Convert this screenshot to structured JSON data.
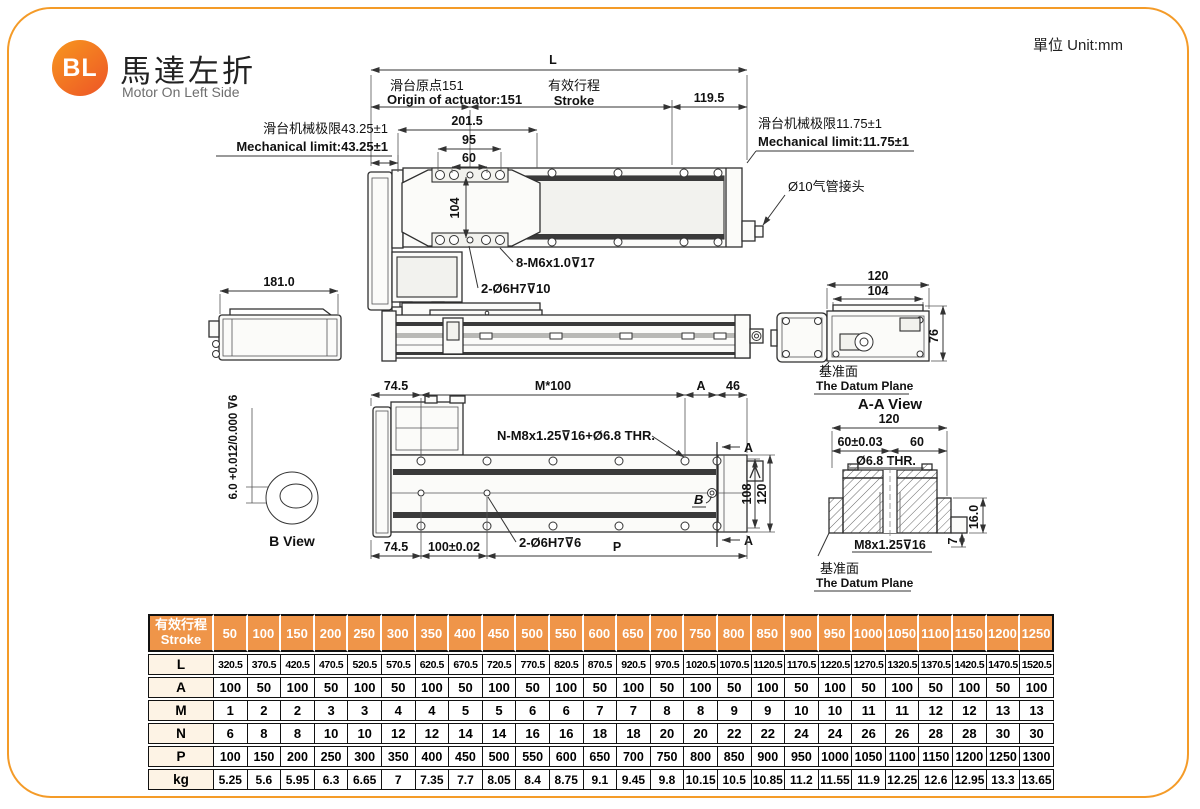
{
  "page": {
    "unit": "單位 Unit:mm",
    "logo_badge": "BL",
    "logo_zh": "馬達左折",
    "logo_en": "Motor On Left Side"
  },
  "ann": {
    "L": "L",
    "origin_zh": "滑台原点151",
    "origin_en": "Origin of actuator:151",
    "stroke_zh": "有效行程",
    "stroke_en": "Stroke",
    "d119": "119.5",
    "mech_l_zh": "滑台机械极限43.25±1",
    "mech_l_en": "Mechanical limit:43.25±1",
    "mech_r_zh": "滑台机械极限11.75±1",
    "mech_r_en": "Mechanical limit:11.75±1",
    "d201": "201.5",
    "d95": "95",
    "d60": "60",
    "d104": "104",
    "m6": "8-M6x1.0⊽17",
    "o6h7_10": "2-Ø6H7⊽10",
    "air": "Ø10气管接头",
    "d181": "181.0",
    "end120": "120",
    "end104": "104",
    "d76": "76",
    "datum_zh": "基准面",
    "datum_en": "The Datum Plane",
    "b74t": "74.5",
    "m100": "M*100",
    "dA": "A",
    "d46": "46",
    "nm8": "N-M8x1.25⊽16+Ø6.8 THR.",
    "o6h7_6": "2-Ø6H7⊽6",
    "b74b": "74.5",
    "d100tol": "100±0.02",
    "dP": "P",
    "d108": "108",
    "d120s": "120",
    "secA": "A",
    "labB": "B",
    "bdim": "6.0 +0.012/0.000 ⊽6",
    "bview": "B View",
    "aa_title": "A-A View",
    "aa120": "120",
    "aa60t": "60±0.03",
    "aa60": "60",
    "aa68": "Ø6.8 THR.",
    "aam8": "M8x1.25⊽16",
    "aa16": "16.0",
    "aa7": "7"
  },
  "table": {
    "header_zh": "有效行程",
    "header_en": "Stroke",
    "strokes": [
      "50",
      "100",
      "150",
      "200",
      "250",
      "300",
      "350",
      "400",
      "450",
      "500",
      "550",
      "600",
      "650",
      "700",
      "750",
      "800",
      "850",
      "900",
      "950",
      "1000",
      "1050",
      "1100",
      "1150",
      "1200",
      "1250"
    ],
    "rows": [
      {
        "label": "L",
        "values": [
          "320.5",
          "370.5",
          "420.5",
          "470.5",
          "520.5",
          "570.5",
          "620.5",
          "670.5",
          "720.5",
          "770.5",
          "820.5",
          "870.5",
          "920.5",
          "970.5",
          "1020.5",
          "1070.5",
          "1120.5",
          "1170.5",
          "1220.5",
          "1270.5",
          "1320.5",
          "1370.5",
          "1420.5",
          "1470.5",
          "1520.5"
        ]
      },
      {
        "label": "A",
        "values": [
          "100",
          "50",
          "100",
          "50",
          "100",
          "50",
          "100",
          "50",
          "100",
          "50",
          "100",
          "50",
          "100",
          "50",
          "100",
          "50",
          "100",
          "50",
          "100",
          "50",
          "100",
          "50",
          "100",
          "50",
          "100"
        ]
      },
      {
        "label": "M",
        "values": [
          "1",
          "2",
          "2",
          "3",
          "3",
          "4",
          "4",
          "5",
          "5",
          "6",
          "6",
          "7",
          "7",
          "8",
          "8",
          "9",
          "9",
          "10",
          "10",
          "11",
          "11",
          "12",
          "12",
          "13",
          "13"
        ]
      },
      {
        "label": "N",
        "values": [
          "6",
          "8",
          "8",
          "10",
          "10",
          "12",
          "12",
          "14",
          "14",
          "16",
          "16",
          "18",
          "18",
          "20",
          "20",
          "22",
          "22",
          "24",
          "24",
          "26",
          "26",
          "28",
          "28",
          "30",
          "30"
        ]
      },
      {
        "label": "P",
        "values": [
          "100",
          "150",
          "200",
          "250",
          "300",
          "350",
          "400",
          "450",
          "500",
          "550",
          "600",
          "650",
          "700",
          "750",
          "800",
          "850",
          "900",
          "950",
          "1000",
          "1050",
          "1100",
          "1150",
          "1200",
          "1250",
          "1300"
        ]
      },
      {
        "label": "kg",
        "values": [
          "5.25",
          "5.6",
          "5.95",
          "6.3",
          "6.65",
          "7",
          "7.35",
          "7.7",
          "8.05",
          "8.4",
          "8.75",
          "9.1",
          "9.45",
          "9.8",
          "10.15",
          "10.5",
          "10.85",
          "11.2",
          "11.55",
          "11.9",
          "12.25",
          "12.6",
          "12.95",
          "13.3",
          "13.65"
        ]
      }
    ]
  }
}
